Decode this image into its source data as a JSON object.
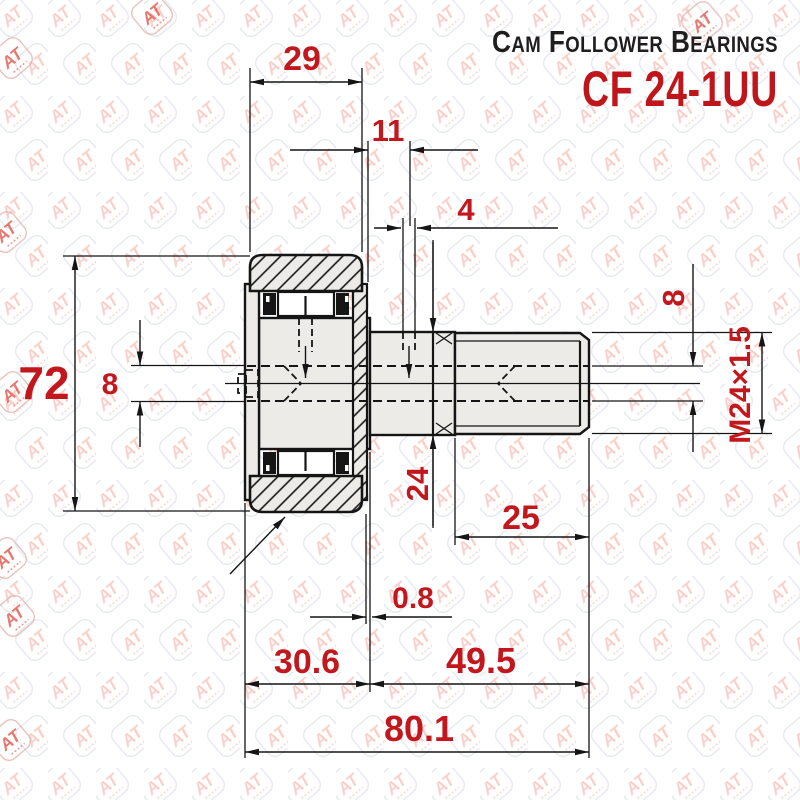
{
  "header": {
    "title": "Cam Follower Bearings",
    "model": "CF 24-1UU"
  },
  "watermark": {
    "text": "AT"
  },
  "colors": {
    "dimension_red": "#c2181d",
    "line_black": "#151515",
    "metal_gray": "#ecebe8",
    "watermark_salmon": "#f5a9a0"
  },
  "drawing": {
    "type": "cam-follower-bearing-cross-section",
    "dimensions": {
      "outer_ring_width": "29",
      "lube_hole_position": "11",
      "lube_hole_diameter": "4",
      "outer_diameter": "72",
      "axial_bore_left": "8",
      "stud_diameter": "24",
      "thread_length": "25",
      "axial_bore_right": "8",
      "thread_spec": "M24×1.5",
      "face_offset": "0.8",
      "bearing_width": "30.6",
      "stud_length": "49.5",
      "overall_length": "80.1"
    }
  }
}
